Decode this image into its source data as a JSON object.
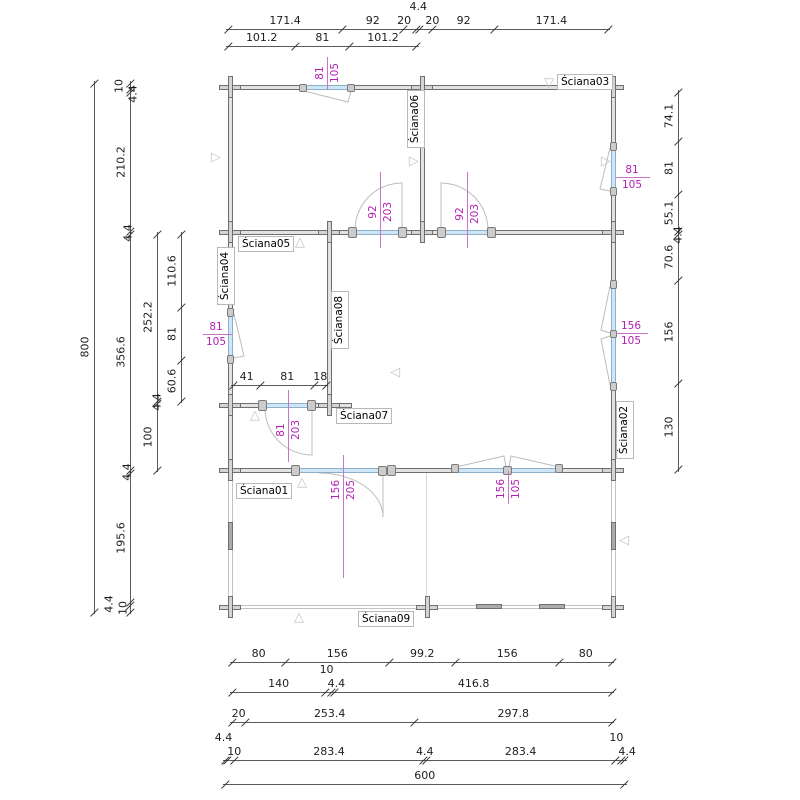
{
  "drawing": {
    "type": "floor-plan",
    "units_total_width": "600",
    "units_total_height": "800",
    "colors": {
      "wall_fill": "#e2e2e2",
      "wall_line": "#6f6f6f",
      "glazing": "#cfe6f6",
      "dim_text": "#1d1d1d",
      "magenta_text": "#b31fb3",
      "magenta_line": "#c875c8",
      "label_border": "#b9b9b9",
      "marker": "#c4c4c4"
    }
  },
  "wall_labels": [
    {
      "id": "sciana01",
      "t": "Ściana01",
      "o": "h",
      "x": 236,
      "y": 483
    },
    {
      "id": "sciana02",
      "t": "Ściana02",
      "o": "v",
      "x": 616,
      "y": 403
    },
    {
      "id": "sciana03",
      "t": "Ściana03",
      "o": "h",
      "x": 557,
      "y": 74
    },
    {
      "id": "sciana04",
      "t": "Ściana04",
      "o": "v",
      "x": 217,
      "y": 249
    },
    {
      "id": "sciana05",
      "t": "Ściana05",
      "o": "h",
      "x": 238,
      "y": 236
    },
    {
      "id": "sciana06",
      "t": "Ściana06",
      "o": "v",
      "x": 407,
      "y": 92
    },
    {
      "id": "sciana07",
      "t": "Ściana07",
      "o": "h",
      "x": 336,
      "y": 408
    },
    {
      "id": "sciana08",
      "t": "Ściana08",
      "o": "v",
      "x": 331,
      "y": 293
    },
    {
      "id": "sciana09",
      "t": "Ściana09",
      "o": "h",
      "x": 358,
      "y": 611
    }
  ],
  "opening_dims": [
    {
      "id": "window-top",
      "o": "v",
      "x": 327,
      "y1": 57,
      "y2": 90,
      "cy": 73,
      "a": "81",
      "b": "105"
    },
    {
      "id": "door-left-92",
      "o": "v",
      "x": 380,
      "y1": 172,
      "y2": 248,
      "cy": 212,
      "a": "92",
      "b": "203"
    },
    {
      "id": "door-right-92",
      "o": "v",
      "x": 467,
      "y1": 172,
      "y2": 248,
      "cy": 214,
      "a": "92",
      "b": "203"
    },
    {
      "id": "door-81",
      "o": "v",
      "x": 288,
      "y1": 390,
      "y2": 462,
      "cy": 430,
      "a": "81",
      "b": "203"
    },
    {
      "id": "door-156",
      "o": "v",
      "x": 343,
      "y1": 455,
      "y2": 578,
      "cy": 490,
      "a": "156",
      "b": "205"
    },
    {
      "id": "window-s01",
      "o": "v",
      "x": 508,
      "y1": 471,
      "y2": 504,
      "cy": 489,
      "a": "156",
      "b": "105"
    },
    {
      "id": "window-left",
      "o": "h",
      "y": 334,
      "x1": 203,
      "x2": 233,
      "cx": 216,
      "a": "81",
      "b": "105"
    },
    {
      "id": "window-right-81",
      "o": "h",
      "y": 177,
      "x1": 616,
      "x2": 650,
      "cx": 632,
      "a": "81",
      "b": "105"
    },
    {
      "id": "window-right-156",
      "o": "h",
      "y": 333,
      "x1": 616,
      "x2": 648,
      "cx": 631,
      "a": "156",
      "b": "105"
    }
  ],
  "dim_chains": [
    {
      "id": "top-outer",
      "o": "h",
      "x": 228,
      "y": 29,
      "segs": [
        {
          "t": "171.4",
          "u": 171.4
        },
        {
          "t": "92",
          "u": 92
        },
        {
          "t": "20",
          "u": 20,
          "dx": -6
        },
        {
          "t": "4.4",
          "u": 4.4,
          "dy": -14
        },
        {
          "t": "20",
          "u": 20,
          "dx": 6
        },
        {
          "t": "92",
          "u": 92
        },
        {
          "t": "171.4",
          "u": 171.4
        }
      ]
    },
    {
      "id": "top-inner",
      "o": "h",
      "x": 228,
      "y": 46,
      "segs": [
        {
          "t": "101.2",
          "u": 101.2
        },
        {
          "t": "81",
          "u": 81
        },
        {
          "t": "101.2",
          "u": 101.2
        }
      ]
    },
    {
      "id": "interior-room",
      "o": "h",
      "x": 233,
      "y": 385,
      "segs": [
        {
          "t": "41",
          "u": 41
        },
        {
          "t": "81",
          "u": 81
        },
        {
          "t": "18",
          "u": 18
        }
      ]
    },
    {
      "id": "left-total",
      "o": "v",
      "x": 94,
      "y": 83,
      "s": 0.661,
      "segs": [
        {
          "t": "800",
          "u": 800
        }
      ]
    },
    {
      "id": "left-outer",
      "o": "v",
      "x": 130,
      "y": 83,
      "s": 0.661,
      "segs": [
        {
          "t": "10",
          "u": 10,
          "dx": -2
        },
        {
          "t": "4.4",
          "u": 4.4,
          "dx": 12,
          "dy": 3
        },
        {
          "t": "210.2",
          "u": 210.2
        },
        {
          "t": "4.4",
          "u": 4.4,
          "dx": 7
        },
        {
          "t": "356.6",
          "u": 356.6
        },
        {
          "t": "4.4",
          "u": 4.4,
          "dx": 6
        },
        {
          "t": "195.6",
          "u": 195.6
        },
        {
          "t": "4.4",
          "u": 4.4,
          "dx": -12
        },
        {
          "t": "10",
          "u": 10,
          "dx": 2
        }
      ]
    },
    {
      "id": "left-mid",
      "o": "v",
      "x": 157,
      "y": 234,
      "s": 0.661,
      "segs": [
        {
          "t": "252.2",
          "u": 252.2
        },
        {
          "t": "4.4",
          "u": 4.4,
          "dx": 9
        },
        {
          "t": "100",
          "u": 100
        }
      ]
    },
    {
      "id": "left-inner",
      "o": "v",
      "x": 181,
      "y": 234,
      "s": 0.661,
      "segs": [
        {
          "t": "110.6",
          "u": 110.6
        },
        {
          "t": "81",
          "u": 81
        },
        {
          "t": "60.6",
          "u": 60.6
        }
      ]
    },
    {
      "id": "right-chain",
      "o": "v",
      "x": 678,
      "y": 92,
      "s": 0.661,
      "segs": [
        {
          "t": "74.1",
          "u": 74.1
        },
        {
          "t": "81",
          "u": 81
        },
        {
          "t": "55.1",
          "u": 55.1
        },
        {
          "t": "4.4",
          "u": 4.4,
          "dx": 9,
          "dy": 3
        },
        {
          "t": "70.6",
          "u": 70.6
        },
        {
          "t": "156",
          "u": 156
        },
        {
          "t": "130",
          "u": 130
        }
      ]
    },
    {
      "id": "bottom-1",
      "o": "h",
      "x": 232,
      "y": 662,
      "segs": [
        {
          "t": "80",
          "u": 80
        },
        {
          "t": "156",
          "u": 156
        },
        {
          "t": "99.2",
          "u": 99.2
        },
        {
          "t": "156",
          "u": 156
        },
        {
          "t": "80",
          "u": 80
        }
      ]
    },
    {
      "id": "bottom-2",
      "o": "h",
      "x": 232,
      "y": 692,
      "segs": [
        {
          "t": "140",
          "u": 140
        },
        {
          "t": "10",
          "u": 10,
          "dy": -14,
          "dx": -2
        },
        {
          "t": "4.4",
          "u": 4.4,
          "dx": 3
        },
        {
          "t": "416.8",
          "u": 416.8
        }
      ]
    },
    {
      "id": "bottom-3",
      "o": "h",
      "x": 232,
      "y": 722,
      "segs": [
        {
          "t": "20",
          "u": 20
        },
        {
          "t": "253.4",
          "u": 253.4
        },
        {
          "t": "297.8",
          "u": 297.8
        }
      ]
    },
    {
      "id": "bottom-4",
      "o": "h",
      "x": 225,
      "y": 760,
      "segs": [
        {
          "t": "4.4",
          "u": 4.4,
          "dy": -14,
          "dx": -3
        },
        {
          "t": "10",
          "u": 10,
          "dx": 3
        },
        {
          "t": "283.4",
          "u": 283.4
        },
        {
          "t": "4.4",
          "u": 4.4
        },
        {
          "t": "283.4",
          "u": 283.4
        },
        {
          "t": "10",
          "u": 10,
          "dy": -14,
          "dx": -2
        },
        {
          "t": "4.4",
          "u": 4.4,
          "dx": 4
        }
      ]
    },
    {
      "id": "bottom-total",
      "o": "h",
      "x": 225,
      "y": 784,
      "segs": [
        {
          "t": "600",
          "u": 600
        }
      ]
    }
  ],
  "markers": [
    {
      "x": 211,
      "y": 151,
      "dir": "right"
    },
    {
      "x": 544,
      "y": 77,
      "dir": "down"
    },
    {
      "x": 409,
      "y": 155,
      "dir": "right"
    },
    {
      "x": 601,
      "y": 155,
      "dir": "right"
    },
    {
      "x": 295,
      "y": 236,
      "dir": "up"
    },
    {
      "x": 390,
      "y": 366,
      "dir": "left"
    },
    {
      "x": 250,
      "y": 409,
      "dir": "up"
    },
    {
      "x": 297,
      "y": 476,
      "dir": "up"
    },
    {
      "x": 294,
      "y": 611,
      "dir": "up"
    },
    {
      "x": 619,
      "y": 534,
      "dir": "left"
    }
  ],
  "junctions": [
    {
      "x": 230,
      "y": 87
    },
    {
      "x": 422,
      "y": 87
    },
    {
      "x": 613,
      "y": 87
    },
    {
      "x": 230,
      "y": 232
    },
    {
      "x": 329,
      "y": 232
    },
    {
      "x": 422,
      "y": 232
    },
    {
      "x": 613,
      "y": 232
    },
    {
      "x": 230,
      "y": 405
    },
    {
      "x": 329,
      "y": 405
    },
    {
      "x": 230,
      "y": 470
    },
    {
      "x": 613,
      "y": 470
    },
    {
      "x": 230,
      "y": 607
    },
    {
      "x": 427,
      "y": 607
    },
    {
      "x": 613,
      "y": 607
    }
  ],
  "jambs": [
    {
      "x": 299,
      "y": 84,
      "w": 8,
      "h": 8
    },
    {
      "x": 347,
      "y": 84,
      "w": 8,
      "h": 8
    },
    {
      "x": 348,
      "y": 227,
      "w": 9,
      "h": 11
    },
    {
      "x": 398,
      "y": 227,
      "w": 9,
      "h": 11
    },
    {
      "x": 437,
      "y": 227,
      "w": 9,
      "h": 11
    },
    {
      "x": 487,
      "y": 227,
      "w": 9,
      "h": 11
    },
    {
      "x": 227,
      "y": 308,
      "w": 7,
      "h": 9
    },
    {
      "x": 227,
      "y": 355,
      "w": 7,
      "h": 9
    },
    {
      "x": 610,
      "y": 142,
      "w": 7,
      "h": 9
    },
    {
      "x": 610,
      "y": 187,
      "w": 7,
      "h": 9
    },
    {
      "x": 610,
      "y": 280,
      "w": 7,
      "h": 9
    },
    {
      "x": 610,
      "y": 330,
      "w": 7,
      "h": 8
    },
    {
      "x": 610,
      "y": 382,
      "w": 7,
      "h": 9
    },
    {
      "x": 258,
      "y": 400,
      "w": 9,
      "h": 11
    },
    {
      "x": 307,
      "y": 400,
      "w": 9,
      "h": 11
    },
    {
      "x": 291,
      "y": 465,
      "w": 9,
      "h": 11
    },
    {
      "x": 378,
      "y": 466,
      "w": 9,
      "h": 10
    },
    {
      "x": 387,
      "y": 465,
      "w": 9,
      "h": 11
    },
    {
      "x": 451,
      "y": 464,
      "w": 8,
      "h": 9
    },
    {
      "x": 503,
      "y": 466,
      "w": 9,
      "h": 9
    },
    {
      "x": 555,
      "y": 464,
      "w": 8,
      "h": 9
    }
  ]
}
